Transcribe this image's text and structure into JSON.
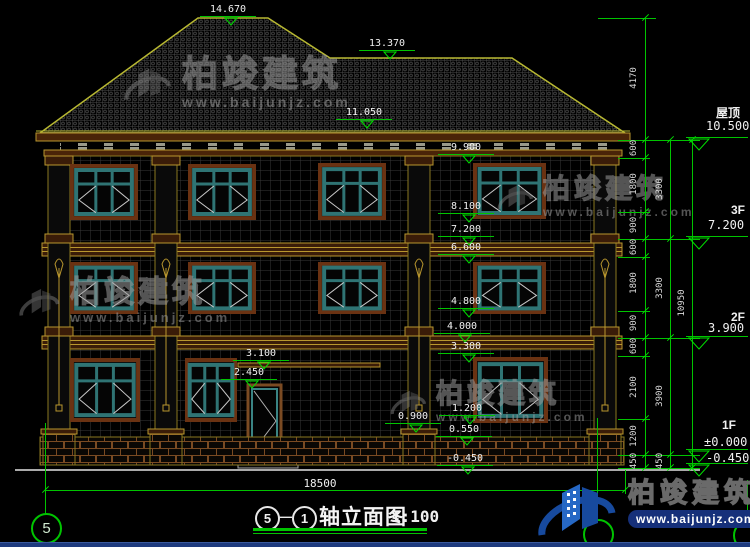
{
  "drawing": {
    "title": {
      "axis_start": "5",
      "separator": "—",
      "axis_end": "1",
      "name": "轴立面图",
      "scale": "1:100"
    },
    "axis_bubble_left": "5",
    "total_width_dim": "18500",
    "floor_levels": [
      {
        "label": "屋顶",
        "value": "10.500",
        "lx": 716,
        "ly": 104,
        "vx": 706,
        "vy": 119,
        "line_y": 137
      },
      {
        "label": "3F",
        "value": "7.200",
        "lx": 731,
        "ly": 203,
        "vx": 708,
        "vy": 218,
        "line_y": 236
      },
      {
        "label": "2F",
        "value": "3.900",
        "lx": 731,
        "ly": 310,
        "vx": 708,
        "vy": 321,
        "line_y": 336
      },
      {
        "label": "1F",
        "value": "±0.000",
        "lx": 722,
        "ly": 418,
        "vx": 704,
        "vy": 435,
        "line_y": 449
      },
      {
        "label": "",
        "value": "-0.450",
        "lx": 0,
        "ly": 0,
        "vx": 706,
        "vy": 451,
        "line_y": 463
      }
    ],
    "elev_markers": [
      {
        "t": "14.670",
        "x": 228,
        "y": 5
      },
      {
        "t": "13.370",
        "x": 387,
        "y": 39
      },
      {
        "t": "11.050",
        "x": 364,
        "y": 108
      },
      {
        "t": "9.900",
        "x": 466,
        "y": 143
      },
      {
        "t": "8.100",
        "x": 466,
        "y": 202
      },
      {
        "t": "7.200",
        "x": 466,
        "y": 225
      },
      {
        "t": "6.600",
        "x": 466,
        "y": 243
      },
      {
        "t": "4.800",
        "x": 466,
        "y": 297
      },
      {
        "t": "4.000",
        "x": 462,
        "y": 322
      },
      {
        "t": "3.300",
        "x": 466,
        "y": 342
      },
      {
        "t": "3.100",
        "x": 261,
        "y": 349
      },
      {
        "t": "2.450",
        "x": 249,
        "y": 368
      },
      {
        "t": "1.200",
        "x": 467,
        "y": 404
      },
      {
        "t": "0.900",
        "x": 413,
        "y": 412
      },
      {
        "t": "0.550",
        "x": 464,
        "y": 425
      },
      {
        "t": "-0.450",
        "x": 465,
        "y": 454
      }
    ],
    "dim_labels": [
      {
        "t": "4170",
        "x": 634,
        "y": 79
      },
      {
        "t": "600",
        "x": 634,
        "y": 149
      },
      {
        "t": "1800",
        "x": 634,
        "y": 185
      },
      {
        "t": "900",
        "x": 634,
        "y": 226
      },
      {
        "t": "600",
        "x": 634,
        "y": 248
      },
      {
        "t": "1800",
        "x": 634,
        "y": 284
      },
      {
        "t": "900",
        "x": 634,
        "y": 324
      },
      {
        "t": "600",
        "x": 634,
        "y": 347
      },
      {
        "t": "2100",
        "x": 634,
        "y": 388
      },
      {
        "t": "1200",
        "x": 634,
        "y": 437
      },
      {
        "t": "450",
        "x": 634,
        "y": 462
      },
      {
        "t": "3300",
        "x": 660,
        "y": 190
      },
      {
        "t": "3300",
        "x": 660,
        "y": 289
      },
      {
        "t": "3900",
        "x": 660,
        "y": 397
      },
      {
        "t": "450",
        "x": 660,
        "y": 462
      },
      {
        "t": "10950",
        "x": 682,
        "y": 304
      }
    ],
    "ext_lines": [
      [
        598,
        18,
        58
      ],
      [
        618,
        140,
        82
      ],
      [
        618,
        158,
        32
      ],
      [
        618,
        212,
        32
      ],
      [
        618,
        239,
        82
      ],
      [
        618,
        257,
        32
      ],
      [
        618,
        311,
        32
      ],
      [
        618,
        338,
        82
      ],
      [
        618,
        356,
        32
      ],
      [
        618,
        419,
        32
      ],
      [
        618,
        455,
        82
      ],
      [
        618,
        468,
        82
      ],
      [
        45,
        490,
        580
      ]
    ],
    "v_lines": [
      [
        645,
        18,
        450
      ],
      [
        670,
        140,
        328
      ],
      [
        692,
        140,
        328
      ],
      [
        45,
        423,
        91
      ],
      [
        597,
        418,
        103
      ],
      [
        625,
        470,
        24
      ],
      [
        747,
        480,
        45
      ]
    ],
    "ticks": [
      [
        645,
        18
      ],
      [
        645,
        140
      ],
      [
        645,
        158
      ],
      [
        645,
        212
      ],
      [
        645,
        239
      ],
      [
        645,
        257
      ],
      [
        645,
        311
      ],
      [
        645,
        338
      ],
      [
        645,
        356
      ],
      [
        645,
        419
      ],
      [
        645,
        455
      ],
      [
        645,
        468
      ],
      [
        670,
        140
      ],
      [
        670,
        239
      ],
      [
        670,
        338
      ],
      [
        670,
        455
      ],
      [
        670,
        468
      ],
      [
        692,
        140
      ],
      [
        692,
        468
      ],
      [
        45,
        490
      ],
      [
        625,
        490
      ]
    ],
    "bubbles": [
      {
        "x": 31,
        "y": 513,
        "d": 27,
        "t": "5"
      },
      {
        "x": 583,
        "y": 519,
        "d": 27,
        "t": ""
      },
      {
        "x": 733,
        "y": 520,
        "d": 27,
        "t": ""
      }
    ],
    "dim_text_pos": {
      "x": 290,
      "y": 477
    }
  },
  "watermark": {
    "brand": "柏竣建筑",
    "url": "www.baijunjz.com",
    "positions": [
      {
        "x": 118,
        "y": 56,
        "f": 36,
        "icon": 58,
        "sub": 14
      },
      {
        "x": 493,
        "y": 176,
        "f": 27,
        "icon": 44,
        "sub": 12
      },
      {
        "x": 14,
        "y": 278,
        "f": 30,
        "icon": 50,
        "sub": 13
      },
      {
        "x": 386,
        "y": 381,
        "f": 27,
        "icon": 44,
        "sub": 12
      }
    ]
  },
  "logo": {
    "brand": "柏竣建筑",
    "url": "www.baijunjz.com"
  },
  "colors": {
    "dim_green": "#00c400",
    "outline_yellow": "#b8b832",
    "trim_brown": "#3a1c08",
    "window_teal": "#2f7474",
    "text_white": "#f0f0f0",
    "logo_blue": "#2668c5",
    "banner_navy": "#16307a"
  }
}
